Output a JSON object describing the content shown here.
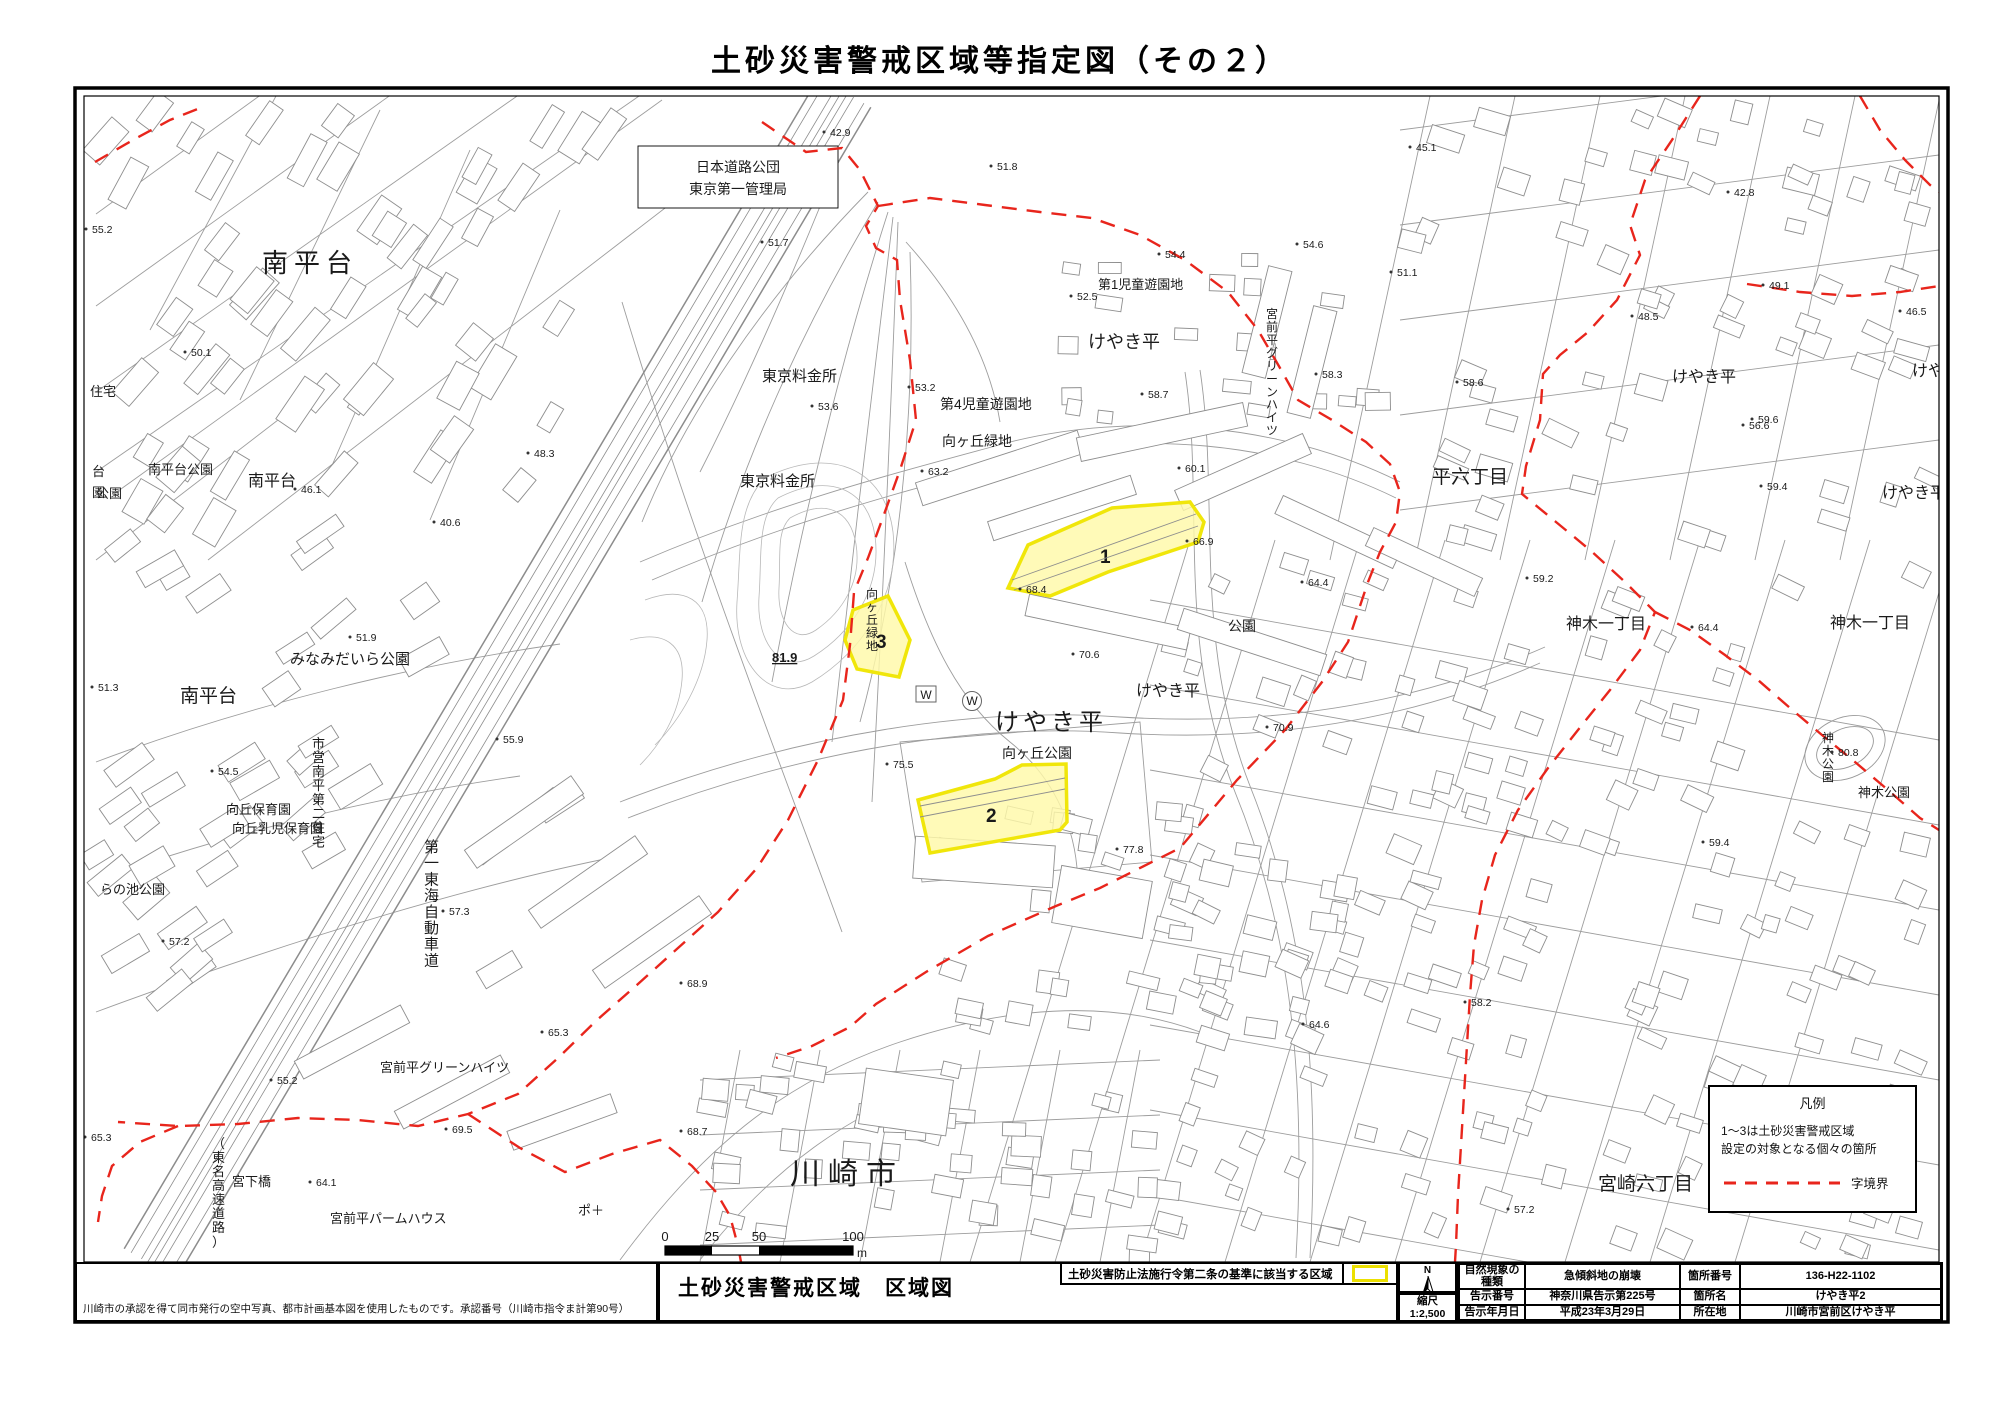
{
  "title": "土砂災害警戒区域等指定図（その２）",
  "legend": {
    "title": "凡例",
    "line1": "1～3は土砂災害警戒区域",
    "line2": "設定の対象となる個々の箇所",
    "boundary_label": "字境界"
  },
  "scalebar": {
    "ticks": [
      "0",
      "25",
      "50",
      "100"
    ],
    "unit": "m"
  },
  "footer": {
    "disclaimer": "川崎市の承認を得て同市発行の空中写真、都市計画基本図を使用したものです。承認番号（川崎市指令ま計第90号）",
    "map_title": "土砂災害警戒区域　区域図",
    "criteria_label": "土砂災害防止法施行令第二条の基準に該当する区域",
    "compass": "N",
    "scale_label": "縮尺",
    "scale_value": "1:2,500",
    "table": {
      "rows": [
        {
          "k1": "自然現象の種類",
          "v1": "急傾斜地の崩壊",
          "k2": "箇所番号",
          "v2": "136-H22-1102"
        },
        {
          "k1": "告示番号",
          "v1": "神奈川県告示第225号",
          "k2": "箇所名",
          "v2": "けやき平2"
        },
        {
          "k1": "告示年月日",
          "v1": "平成23年3月29日",
          "k2": "所在地",
          "v2": "川崎市宮前区けやき平"
        }
      ]
    }
  },
  "map": {
    "zone_fill": "#fff9a8",
    "zone_stroke": "#f0e60a",
    "boundary_color": "#e8251c",
    "zones": [
      {
        "no": "1",
        "points": "1008,588 1028,545 1112,508 1190,502 1204,522 1198,542 1108,572 1050,596",
        "label_x": 1100,
        "label_y": 563
      },
      {
        "no": "2",
        "points": "918,800 995,779 1022,765 1066,764 1067,822 1060,830 930,853",
        "label_x": 986,
        "label_y": 822
      },
      {
        "no": "3",
        "points": "845,640 853,610 888,596 910,640 899,677 857,669",
        "label_x": 876,
        "label_y": 648
      }
    ],
    "labels": [
      {
        "t": "南平台",
        "x": 262,
        "y": 272,
        "s": 26,
        "sp": 6
      },
      {
        "t": "南平台",
        "x": 248,
        "y": 486,
        "s": 16
      },
      {
        "t": "南平台公園",
        "x": 148,
        "y": 474,
        "s": 13
      },
      {
        "t": "公園",
        "x": 96,
        "y": 498,
        "s": 13
      },
      {
        "t": "住宅",
        "x": 90,
        "y": 396,
        "s": 13
      },
      {
        "t": "台",
        "x": 92,
        "y": 476,
        "s": 13
      },
      {
        "t": "園",
        "x": 92,
        "y": 497,
        "s": 13
      },
      {
        "t": "南平台",
        "x": 180,
        "y": 702,
        "s": 19
      },
      {
        "t": "みなみだいら公園",
        "x": 290,
        "y": 664,
        "s": 15
      },
      {
        "t": "向丘保育園",
        "x": 226,
        "y": 814,
        "s": 13
      },
      {
        "t": "向丘乳児保育園",
        "x": 232,
        "y": 833,
        "s": 13
      },
      {
        "t": "らの池公園",
        "x": 100,
        "y": 894,
        "s": 13
      },
      {
        "t": "市営南平第二住宅",
        "x": 312,
        "y": 748,
        "s": 13,
        "v": true
      },
      {
        "t": "第一東海自動車道",
        "x": 424,
        "y": 852,
        "s": 15,
        "v": true
      },
      {
        "t": "（東名高速道路）",
        "x": 212,
        "y": 1148,
        "s": 13,
        "v": true
      },
      {
        "t": "宮下橋",
        "x": 232,
        "y": 1186,
        "s": 13
      },
      {
        "t": "宮前平グリーンハイツ",
        "x": 380,
        "y": 1072,
        "s": 13
      },
      {
        "t": "宮前平パームハウス",
        "x": 330,
        "y": 1223,
        "s": 13
      },
      {
        "t": "ポ＋",
        "x": 578,
        "y": 1215,
        "s": 13
      },
      {
        "t": "川崎市",
        "x": 790,
        "y": 1184,
        "s": 30,
        "sp": 8
      },
      {
        "t": "宮崎六丁目",
        "x": 1598,
        "y": 1190,
        "s": 19
      },
      {
        "t": "日本道路公団",
        "x": 738,
        "y": 172,
        "s": 14,
        "a": "m"
      },
      {
        "t": "東京第一管理局",
        "x": 738,
        "y": 194,
        "s": 14,
        "a": "m"
      },
      {
        "t": "東京料金所",
        "x": 762,
        "y": 381,
        "s": 15
      },
      {
        "t": "東京料金所",
        "x": 740,
        "y": 486,
        "s": 15
      },
      {
        "t": "第4児童遊園地",
        "x": 940,
        "y": 409,
        "s": 14
      },
      {
        "t": "向ヶ丘緑地",
        "x": 942,
        "y": 446,
        "s": 14
      },
      {
        "t": "第1児童遊園地",
        "x": 1098,
        "y": 289,
        "s": 13
      },
      {
        "t": "けやき平",
        "x": 1088,
        "y": 348,
        "s": 18
      },
      {
        "t": "宮前平グリーンハイツ",
        "x": 1266,
        "y": 318,
        "s": 12,
        "v": true
      },
      {
        "t": "けやき平",
        "x": 995,
        "y": 730,
        "s": 24,
        "sp": 4
      },
      {
        "t": "けやき平",
        "x": 1136,
        "y": 696,
        "s": 16
      },
      {
        "t": "向ヶ丘公園",
        "x": 1002,
        "y": 758,
        "s": 14
      },
      {
        "t": "公園",
        "x": 1228,
        "y": 631,
        "s": 14
      },
      {
        "t": "平六丁目",
        "x": 1432,
        "y": 483,
        "s": 19
      },
      {
        "t": "けやき平",
        "x": 1672,
        "y": 382,
        "s": 16
      },
      {
        "t": "けや",
        "x": 1912,
        "y": 376,
        "s": 16
      },
      {
        "t": "けやき平",
        "x": 1882,
        "y": 498,
        "s": 16
      },
      {
        "t": "神木一丁目",
        "x": 1566,
        "y": 629,
        "s": 16
      },
      {
        "t": "神木一丁目",
        "x": 1830,
        "y": 628,
        "s": 16
      },
      {
        "t": "神木公園",
        "x": 1822,
        "y": 742,
        "s": 12,
        "v": true
      },
      {
        "t": "神木公園",
        "x": 1858,
        "y": 797,
        "s": 13
      },
      {
        "t": "向ヶ丘緑地",
        "x": 866,
        "y": 598,
        "s": 12,
        "v": true
      },
      {
        "t": "81.9",
        "x": 772,
        "y": 662,
        "s": 13,
        "b": true,
        "u": true
      }
    ],
    "elevations": [
      [
        "42.9",
        830,
        136
      ],
      [
        "51.8",
        997,
        170
      ],
      [
        "45.1",
        1416,
        151
      ],
      [
        "51.7",
        768,
        246
      ],
      [
        "52.5",
        1077,
        300
      ],
      [
        "53.2",
        915,
        391
      ],
      [
        "53.6",
        818,
        410
      ],
      [
        "63.2",
        928,
        475
      ],
      [
        "58.7",
        1148,
        398
      ],
      [
        "60.1",
        1185,
        472
      ],
      [
        "54.4",
        1165,
        258
      ],
      [
        "54.6",
        1303,
        248
      ],
      [
        "51.1",
        1397,
        276
      ],
      [
        "58.3",
        1322,
        378
      ],
      [
        "58.6",
        1463,
        386
      ],
      [
        "59.2",
        1533,
        582
      ],
      [
        "56.6",
        1749,
        429
      ],
      [
        "48.5",
        1638,
        320
      ],
      [
        "49.1",
        1769,
        289
      ],
      [
        "42.8",
        1734,
        196
      ],
      [
        "46.5",
        1906,
        315
      ],
      [
        "59.6",
        1758,
        423
      ],
      [
        "59.4",
        1767,
        490
      ],
      [
        "66.9",
        1193,
        545
      ],
      [
        "68.4",
        1026,
        593
      ],
      [
        "64.4",
        1308,
        586
      ],
      [
        "64.4",
        1698,
        631
      ],
      [
        "70.6",
        1079,
        658
      ],
      [
        "70.9",
        1273,
        731
      ],
      [
        "75.5",
        893,
        768
      ],
      [
        "77.8",
        1123,
        853
      ],
      [
        "64.6",
        1309,
        1028
      ],
      [
        "58.2",
        1471,
        1006
      ],
      [
        "80.8",
        1838,
        756
      ],
      [
        "59.4",
        1709,
        846
      ],
      [
        "57.2",
        1514,
        1213
      ],
      [
        "55.2",
        92,
        233
      ],
      [
        "50.1",
        191,
        356
      ],
      [
        "48.3",
        534,
        457
      ],
      [
        "46.1",
        301,
        493
      ],
      [
        "40.6",
        440,
        526
      ],
      [
        "51.3",
        98,
        691
      ],
      [
        "51.9",
        356,
        641
      ],
      [
        "54.5",
        218,
        775
      ],
      [
        "55.9",
        503,
        743
      ],
      [
        "57.3",
        449,
        915
      ],
      [
        "57.2",
        169,
        945
      ],
      [
        "55.2",
        277,
        1084
      ],
      [
        "65.3",
        91,
        1141
      ],
      [
        "65.3",
        548,
        1036
      ],
      [
        "69.5",
        452,
        1133
      ],
      [
        "64.1",
        316,
        1186
      ],
      [
        "68.9",
        687,
        987
      ],
      [
        "68.7",
        687,
        1135
      ]
    ],
    "w_marks": [
      "W",
      "W"
    ]
  }
}
